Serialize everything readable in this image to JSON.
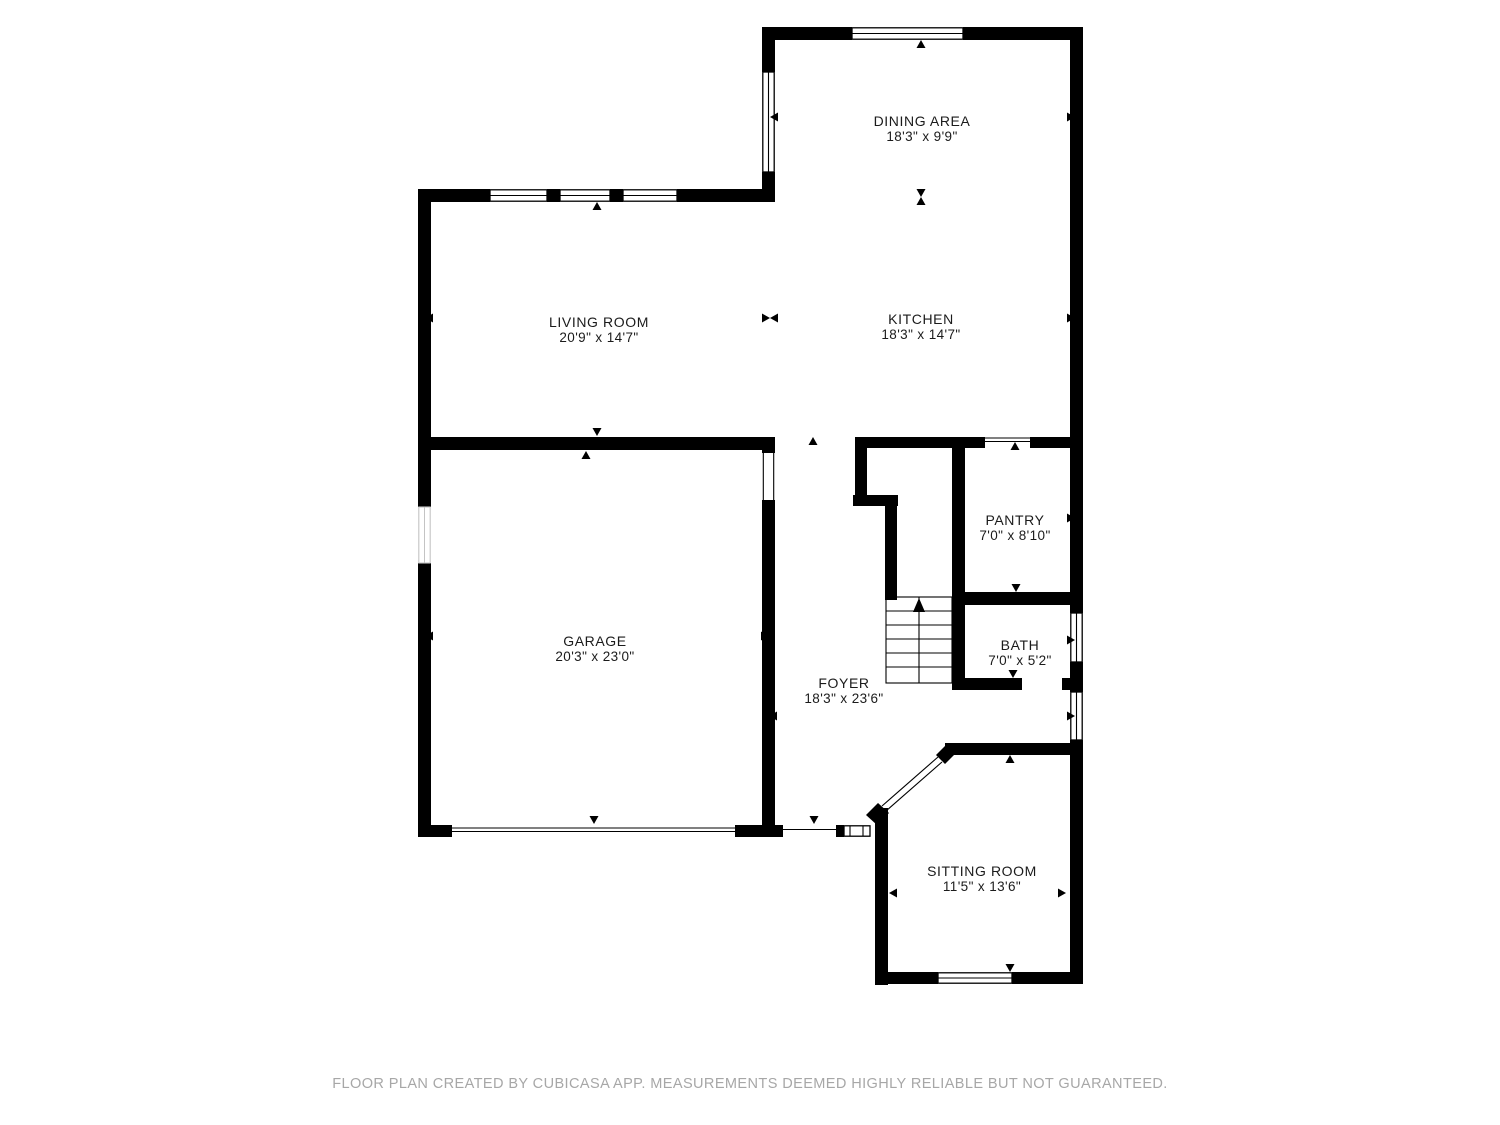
{
  "plan": {
    "rooms": [
      {
        "id": "dining-area",
        "name": "DINING AREA",
        "dims": "18'3\" x 9'9\""
      },
      {
        "id": "living-room",
        "name": "LIVING ROOM",
        "dims": "20'9\" x 14'7\""
      },
      {
        "id": "kitchen",
        "name": "KITCHEN",
        "dims": "18'3\" x 14'7\""
      },
      {
        "id": "pantry",
        "name": "PANTRY",
        "dims": "7'0\" x 8'10\""
      },
      {
        "id": "garage",
        "name": "GARAGE",
        "dims": "20'3\" x 23'0\""
      },
      {
        "id": "bath",
        "name": "BATH",
        "dims": "7'0\" x 5'2\""
      },
      {
        "id": "foyer",
        "name": "FOYER",
        "dims": "18'3\" x 23'6\""
      },
      {
        "id": "sitting-room",
        "name": "SITTING ROOM",
        "dims": "11'5\" x 13'6\""
      }
    ],
    "markers": [
      {
        "dir": "up",
        "x": 921,
        "y": 40
      },
      {
        "dir": "left",
        "x": 770,
        "y": 117
      },
      {
        "dir": "right",
        "x": 1075,
        "y": 117
      },
      {
        "dir": "updown",
        "x": 921,
        "y": 197
      },
      {
        "dir": "up",
        "x": 597,
        "y": 202
      },
      {
        "dir": "left",
        "x": 425,
        "y": 318
      },
      {
        "dir": "leftright",
        "x": 770,
        "y": 318
      },
      {
        "dir": "right",
        "x": 1075,
        "y": 318
      },
      {
        "dir": "down",
        "x": 597,
        "y": 436
      },
      {
        "dir": "up",
        "x": 586,
        "y": 451
      },
      {
        "dir": "up",
        "x": 813,
        "y": 437
      },
      {
        "dir": "up",
        "x": 1015,
        "y": 442
      },
      {
        "dir": "left",
        "x": 425,
        "y": 636
      },
      {
        "dir": "right",
        "x": 769,
        "y": 636
      },
      {
        "dir": "left",
        "x": 769,
        "y": 716
      },
      {
        "dir": "right",
        "x": 1075,
        "y": 716
      },
      {
        "dir": "left",
        "x": 956,
        "y": 518
      },
      {
        "dir": "right",
        "x": 1075,
        "y": 518
      },
      {
        "dir": "down",
        "x": 1016,
        "y": 592
      },
      {
        "dir": "left",
        "x": 956,
        "y": 640
      },
      {
        "dir": "right",
        "x": 1075,
        "y": 640
      },
      {
        "dir": "down",
        "x": 1013,
        "y": 678
      },
      {
        "dir": "up",
        "x": 1010,
        "y": 755
      },
      {
        "dir": "left",
        "x": 889,
        "y": 893
      },
      {
        "dir": "right",
        "x": 1066,
        "y": 893
      },
      {
        "dir": "down",
        "x": 1010,
        "y": 972
      },
      {
        "dir": "down",
        "x": 594,
        "y": 824
      },
      {
        "dir": "down",
        "x": 814,
        "y": 824
      }
    ],
    "colors": {
      "wall": "#000000",
      "label": "#1b1b1b",
      "footer": "#a7a7a7"
    }
  },
  "footer": {
    "text": "FLOOR PLAN CREATED BY CUBICASA APP. MEASUREMENTS DEEMED HIGHLY RELIABLE BUT NOT GUARANTEED."
  }
}
